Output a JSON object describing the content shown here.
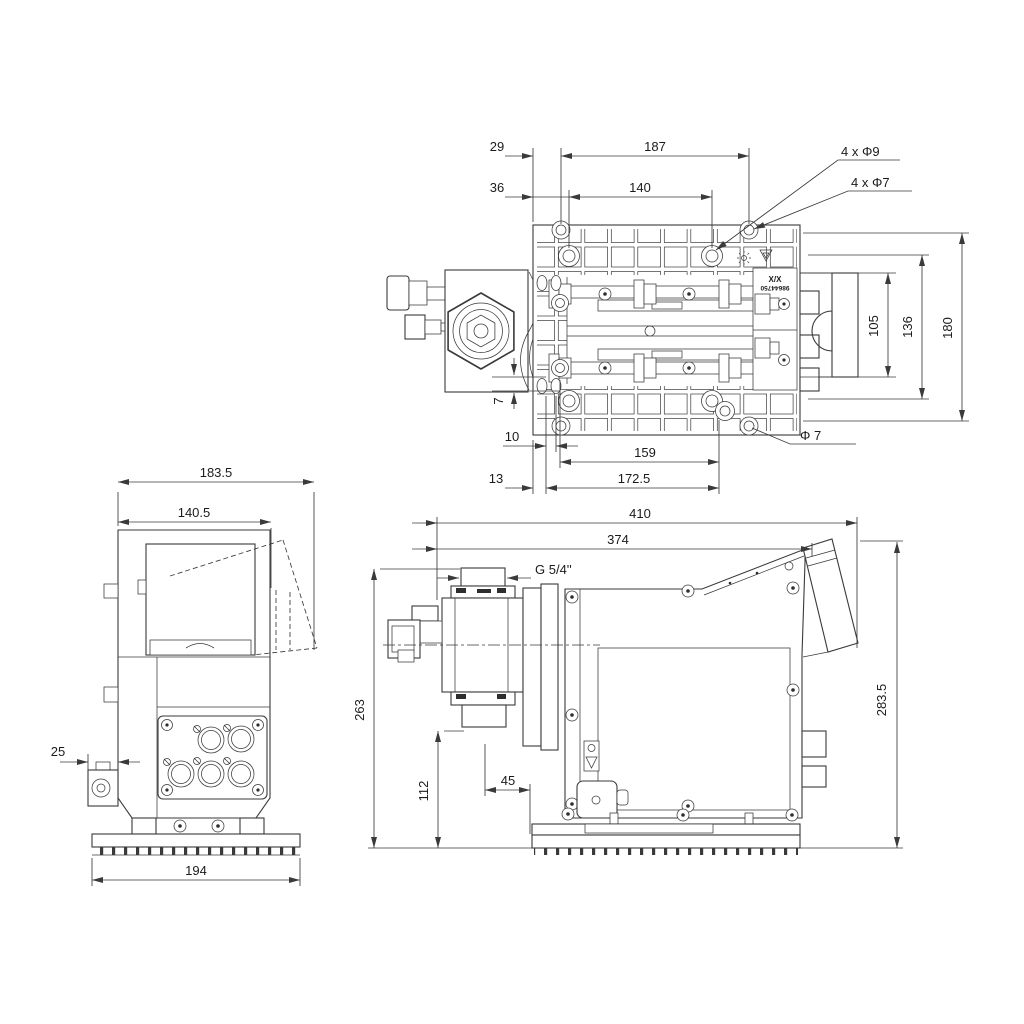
{
  "views": {
    "top": {
      "name": "top-view",
      "dims": {
        "w29": "29",
        "w187": "187",
        "w36": "36",
        "w140": "140",
        "holes9": "4 x Φ9",
        "holes7": "4 x Φ7",
        "h105": "105",
        "h136": "136",
        "h180": "180",
        "off7": "7",
        "w10": "10",
        "w159": "159",
        "dia7": "Φ 7",
        "w13": "13",
        "w172": "172.5"
      },
      "labels": {
        "variant": "X/X",
        "part_number": "98644750"
      }
    },
    "left": {
      "name": "left-side-view",
      "dims": {
        "w183": "183.5",
        "w140": "140.5",
        "d25": "25",
        "w194": "194"
      }
    },
    "front": {
      "name": "front-view",
      "dims": {
        "w410": "410",
        "w374": "374",
        "thread": "G 5/4''",
        "h263": "263",
        "h112": "112",
        "w45": "45",
        "h283": "283.5"
      }
    }
  },
  "colors": {
    "line": "#3a3a3a",
    "text": "#1b1b1b",
    "background": "#ffffff"
  }
}
